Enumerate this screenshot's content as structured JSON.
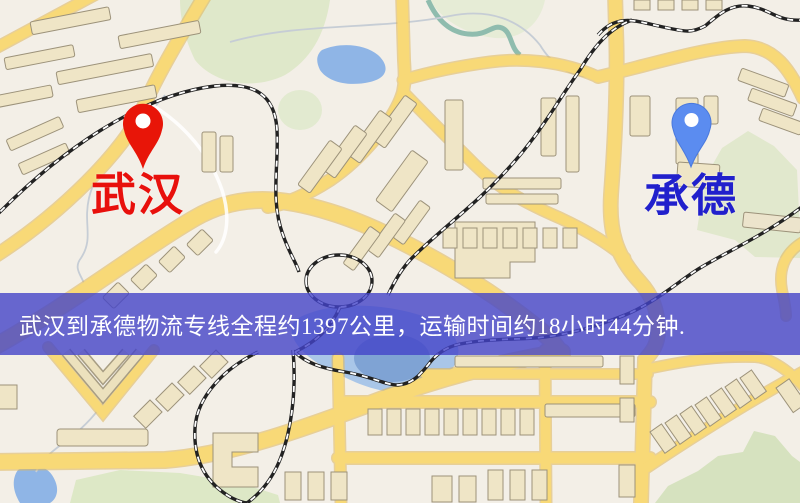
{
  "banner": {
    "text": "武汉到承德物流专线全程约1397公里，运输时间约18小时44分钟."
  },
  "markers": {
    "origin": {
      "label": "武汉"
    },
    "destination": {
      "label": "承德"
    }
  },
  "colors": {
    "origin_pin": "#e81508",
    "origin_label": "#e8100c",
    "destination_pin": "#5b8cf0",
    "destination_label": "#2120cc",
    "banner_bg": "rgba(68,68,200,0.8)",
    "banner_text": "#ffffff",
    "road": "#f8d977",
    "road_casing": "#dfb558",
    "railway": "#222222",
    "water": "#8fb5e6",
    "park": "#dfe8ca",
    "background": "#f3efe7"
  }
}
